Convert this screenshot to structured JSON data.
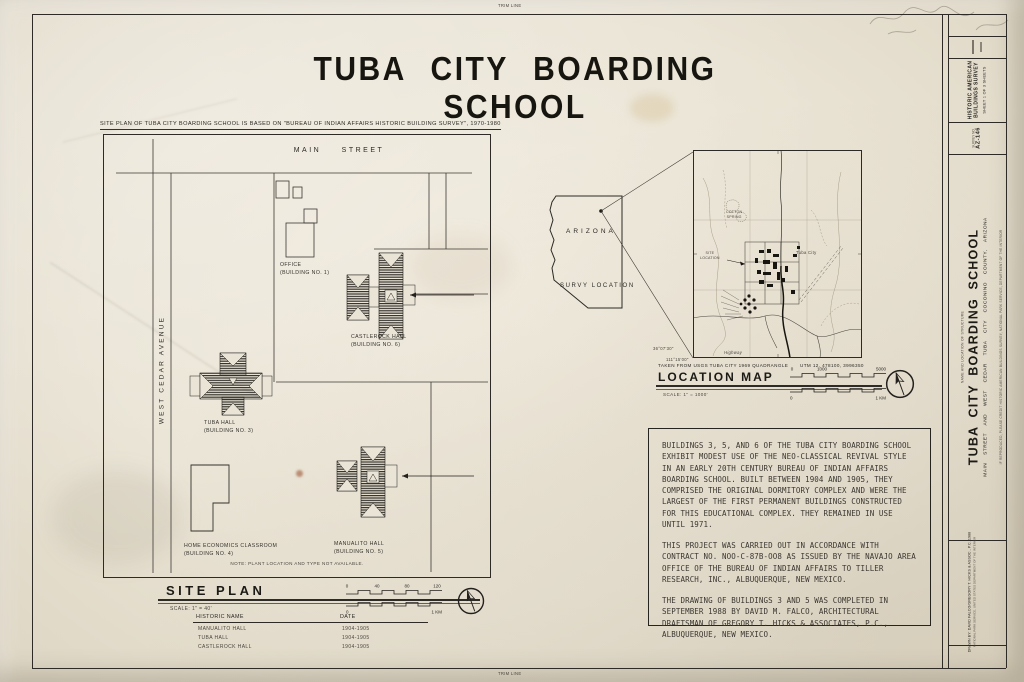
{
  "sheet": {
    "trim_label": "TRIM LINE",
    "title": "TUBA CITY BOARDING SCHOOL",
    "source_note": "SITE PLAN OF TUBA CITY BOARDING SCHOOL IS BASED ON \"BUREAU OF INDIAN AFFAIRS HISTORIC BUILDING SURVEY\", 1970-1980"
  },
  "site_plan": {
    "street_main": "MAIN STREET",
    "street_west": "WEST CEDAR AVENUE",
    "buildings": {
      "office": {
        "name": "OFFICE",
        "number": "(BUILDING NO. 1)"
      },
      "castlerock": {
        "name": "CASTLEROCK HALL",
        "number": "(BUILDING NO. 6)"
      },
      "tuba": {
        "name": "TUBA HALL",
        "number": "(BUILDING NO. 3)"
      },
      "home_economics": {
        "name": "HOME ECONOMICS CLASSROOM",
        "number": "(BUILDING NO. 4)"
      },
      "manualito": {
        "name": "MANUALITO HALL",
        "number": "(BUILDING NO. 5)"
      }
    },
    "note": "NOTE: PLANT LOCATION AND TYPE NOT AVAILABLE.",
    "heading": "SITE PLAN",
    "scale_label": "SCALE: 1\" = 40'",
    "scalebar_feet": {
      "t0": "0",
      "t1": "40",
      "t2": "80",
      "t3": "120"
    },
    "scalebar_metric": {
      "start": "0",
      "end": "1 KM"
    },
    "table": {
      "col_name": "HISTORIC NAME",
      "col_date": "DATE",
      "rows": [
        {
          "name": "MANUALITO HALL",
          "date": "1904-1905"
        },
        {
          "name": "TUBA HALL",
          "date": "1904-1905"
        },
        {
          "name": "CASTLEROCK HALL",
          "date": "1904-1905"
        }
      ]
    }
  },
  "location": {
    "state": "ARIZONA",
    "survey_location": "SURVY LOCATION",
    "map": {
      "town": "Tuba City",
      "site_line1": "SITE",
      "site_line2": "LOCATION",
      "spring_line1": "COTTON",
      "spring_line2": "SPRING",
      "highway": "Highway",
      "lat": "36°07'30\"",
      "lon": "111°15'00\""
    },
    "caption": "TAKEN FROM USGS TUBA CITY 1969 QUADRANGLE",
    "utm": "UTM 12, 478100, 3996350",
    "heading": "LOCATION MAP",
    "scale_label": "SCALE: 1\" = 1000'",
    "scalebar_feet": {
      "t0": "0",
      "t1": "1000",
      "t2": "5000"
    },
    "scalebar_metric": {
      "start": "0",
      "end": "1 KM"
    }
  },
  "description": {
    "para1": "BUILDINGS 3, 5, AND 6 OF THE TUBA CITY BOARDING SCHOOL EXHIBIT MODEST USE OF THE NEO-CLASSICAL REVIVAL STYLE IN AN EARLY 20TH CENTURY BUREAU OF INDIAN AFFAIRS BOARDING SCHOOL.  BUILT BETWEEN 1904 AND 1905, THEY COMPRISED THE ORIGINAL DORMITORY COMPLEX AND WERE THE LARGEST OF THE FIRST PERMANENT BUILDINGS CONSTRUCTED FOR THIS EDUCATIONAL COMPLEX.  THEY REMAINED IN USE UNTIL 1971.",
    "para2": "THIS PROJECT WAS CARRIED OUT IN ACCORDANCE WITH CONTRACT NO. NOO-C-87B-OO8 AS ISSUED BY THE NAVAJO AREA OFFICE OF THE BUREAU OF INDIAN AFFAIRS TO TILLER RESEARCH, INC., ALBUQUERQUE, NEW MEXICO.",
    "para3": "THE DRAWING OF BUILDINGS 3 AND 5 WAS COMPLETED IN SEPTEMBER 1988 BY DAVID M. FALCO, ARCHITECTURAL DRAFTSMAN OF GREGORY T. HICKS & ASSOCIATES, P.C., ALBUQUERQUE, NEW MEXICO."
  },
  "title_block": {
    "survey_line1": "HISTORIC AMERICAN",
    "survey_line2": "BUILDINGS SURVEY",
    "sheet_info": "SHEET 1 OF 3 SHEETS",
    "survey_no_label": "SURVEY NO.",
    "survey_no": "AZ-146",
    "structure_header": "NAME AND LOCATION OF STRUCTURE",
    "structure_title": "TUBA CITY BOARDING SCHOOL",
    "structure_address": "MAIN STREET AND WEST CEDAR TUBA CITY COCONINO COUNTY, ARIZONA",
    "credit": "IF REPRODUCED, PLEASE CREDIT HISTORIC AMERICAN BUILDINGS SURVEY, NATIONAL PARK SERVICE, DEPARTMENT OF THE INTERIOR",
    "drawn_by": "DRAWN BY: DAVID FALCO/GREGORY T. HICKS & ASSOC., P.C. 1988",
    "agency": "NATIONAL PARK SERVICE, UNITED STATES DEPARTMENT OF THE INTERIOR"
  }
}
